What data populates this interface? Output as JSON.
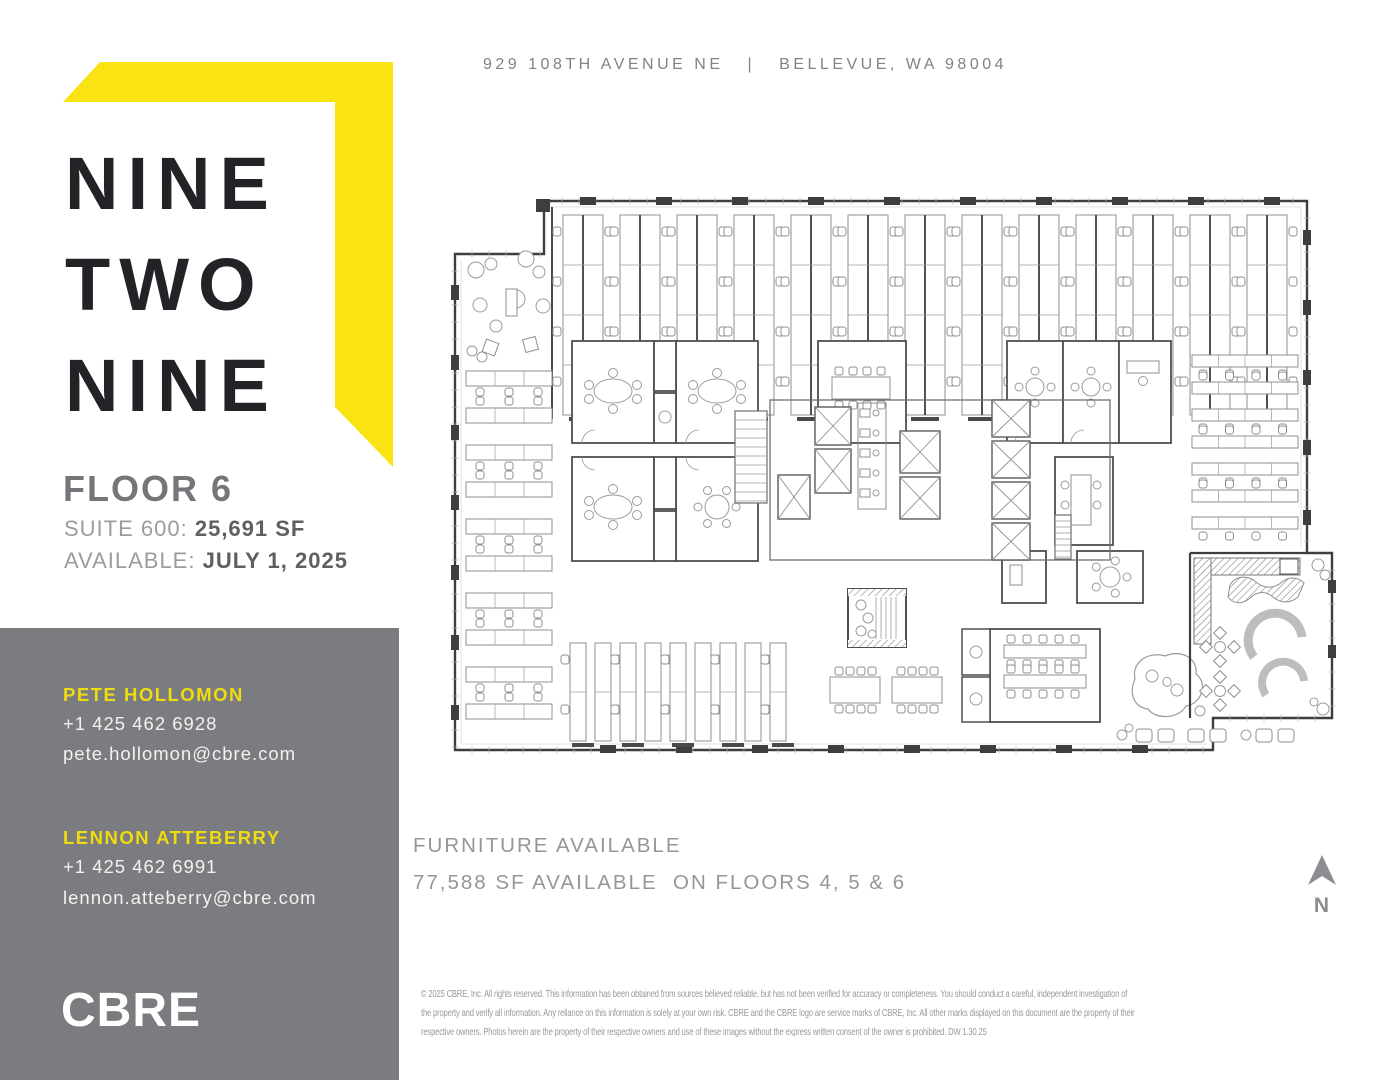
{
  "header": {
    "address": "929 108TH AVENUE NE",
    "separator": "|",
    "city": "BELLEVUE, WA 98004"
  },
  "brand": {
    "lines": [
      "NINE",
      "TWO",
      "NINE"
    ],
    "mark_icon": "yellow-corner-bracket-mark"
  },
  "listing": {
    "floor": "FLOOR 6",
    "suite_label": "SUITE 600: ",
    "suite_value": "25,691 SF",
    "available_label": "AVAILABLE: ",
    "available_value": "JULY 1, 2025"
  },
  "contacts": [
    {
      "name": "PETE HOLLOMON",
      "phone": "+1 425 462 6928",
      "email": "pete.hollomon@cbre.com"
    },
    {
      "name": "LENNON ATTEBERRY",
      "phone": "+1 425 462 6991",
      "email": "lennon.atteberry@cbre.com"
    }
  ],
  "logo": {
    "text": "CBRE"
  },
  "availability": {
    "line1": "FURNITURE AVAILABLE",
    "line2": "77,588 SF AVAILABLE  ON FLOORS 4, 5 & 6"
  },
  "compass": {
    "label": "N",
    "icon": "north-arrow-icon"
  },
  "floor_plan": {
    "icon": "floor-plan-drawing",
    "description": "Floor 6 architectural furniture plan"
  },
  "disclaimer": {
    "lines": [
      "© 2025  CBRE, Inc. All rights reserved. This information has been obtained from sources believed reliable, but has not been verified for accuracy or completeness. You should conduct a careful, independent investigation of",
      "the property and verify all information. Any reliance on this information is solely at your own risk. CBRE and the CBRE logo are service marks of CBRE, Inc. All other marks displayed on this document are the property of their",
      "respective owners. Photos herein are the property of their respective owners and use of these images without the express written consent of the owner is prohibited.  DW 1.30.25"
    ]
  },
  "colors": {
    "brand_yellow": "#FAE313",
    "accent_yellow_on_gray": "#EFDC10",
    "panel_gray": "#7B7C7F",
    "ink": "#222326",
    "heading_gray": "#75767A",
    "label_gray": "#9B9C9F",
    "value_gray": "#5E5F62",
    "address_gray": "#808285",
    "body_gray": "#95969A",
    "disclaimer_gray": "#97989B",
    "plan_wall": "#3E3E3E"
  }
}
